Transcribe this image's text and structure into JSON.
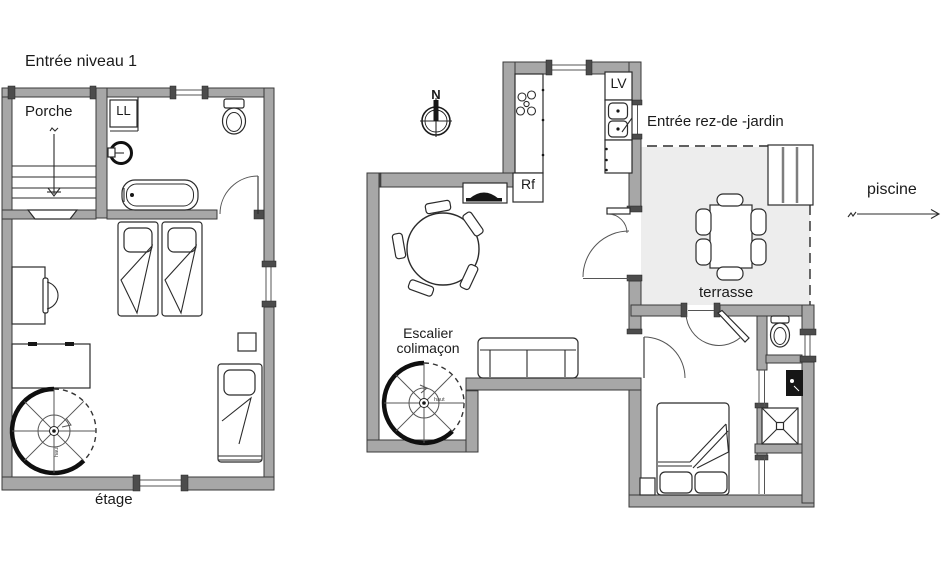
{
  "colors": {
    "wall_fill": "#a7a7a7",
    "wall_cap": "#4c4c4c",
    "line": "#2b2b2b",
    "terrace_fill": "#ededed",
    "text": "#1b1b1b",
    "background": "#ffffff"
  },
  "plans": {
    "level1": {
      "title": "Entrée niveau 1",
      "rooms": {
        "porch": "Porche"
      },
      "labels": {
        "washer": "LL",
        "floor": "étage",
        "stair_up": "haut"
      }
    },
    "garden": {
      "title": "Entrée rez-de -jardin",
      "labels": {
        "dishwasher": "LV",
        "fridge": "Rf",
        "stair_line1": "Escalier",
        "stair_line2": "colimaçon",
        "terrace": "terrasse",
        "pool": "piscine",
        "stair_up": "haut",
        "compass_north": "N"
      }
    }
  }
}
